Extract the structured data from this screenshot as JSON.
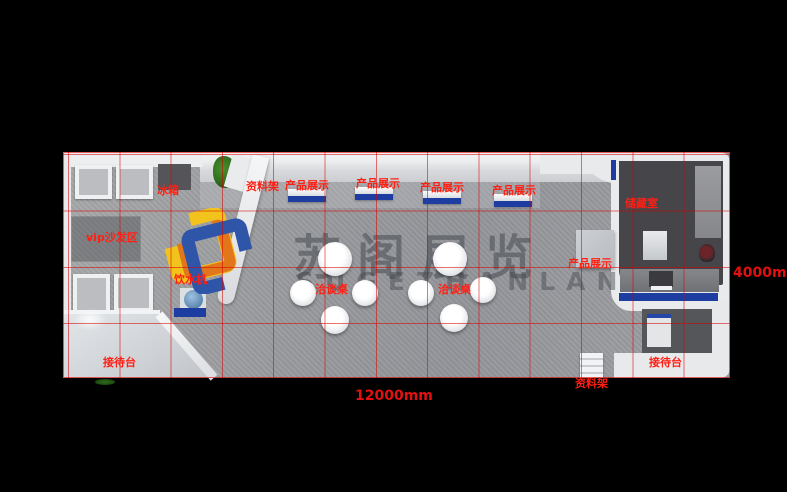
{
  "scene": {
    "description_cn": "展台设计俯视效果图",
    "plan_width_mm": 12000,
    "plan_depth_mm": 4000
  },
  "watermark": {
    "title_cn": "苏阁展览",
    "title_en": "SUGEZHANLAN"
  },
  "dimensions": {
    "width": "12000mm",
    "height": "4000mm"
  },
  "annotations": {
    "fridge": "冰箱",
    "rack_top": "资料架",
    "product_display_1": "产品展示",
    "product_display_2": "产品展示",
    "product_display_3": "产品展示",
    "product_display_4": "产品展示",
    "product_display_5": "产品展示",
    "vip_sofa_area": "vip沙发区",
    "water_dispenser": "饮水机",
    "meeting_table_1": "洽谈桌",
    "meeting_table_2": "洽谈桌",
    "storage_room": "储藏室",
    "reception_left": "接待台",
    "reception_right": "接待台",
    "rack_bottom": "资料架"
  },
  "colors": {
    "background": "#000000",
    "grid_line": "#d40000",
    "annotation_red": "#ff2014",
    "accent_blue": "#1d3da0",
    "floor_gray": "#9a9b9e",
    "storage_floor": "#45454a",
    "logo_yellow": "#f2c31c",
    "logo_orange": "#e2761b",
    "logo_blue": "#2f55a8"
  }
}
